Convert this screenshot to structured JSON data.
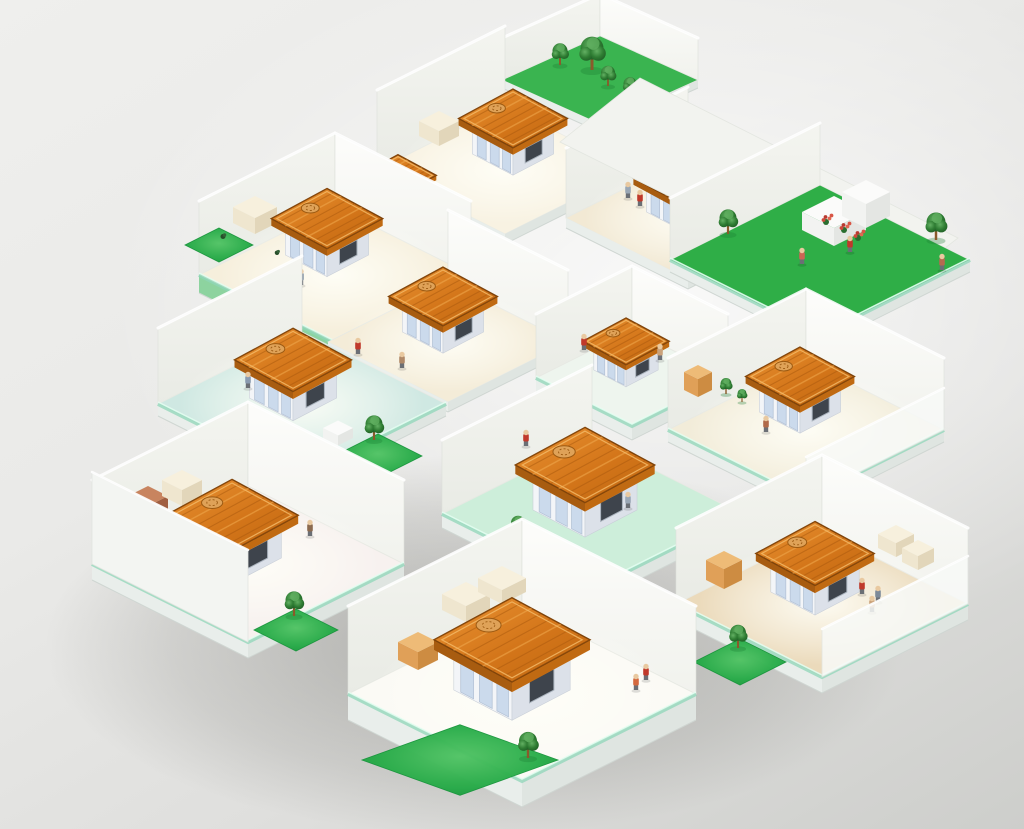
{
  "scene": {
    "type": "isometric-building-cutaway-illustration",
    "background": {
      "light": "#efefed",
      "dark": "#cdcecb"
    },
    "palette": {
      "roof_top_light": "#e89232",
      "roof_top": "#d4761a",
      "roof_top_dark": "#bd650f",
      "roof_side_left": "#a85c10",
      "roof_side_right": "#c06a12",
      "roof_grain": "#a8590e",
      "roof_grain_light": "#f0a94f",
      "roof_rim_dark": "#7e430a",
      "roof_rim_light": "#f3b866",
      "medallion": "#dfa258",
      "medallion_line": "#9c5a12",
      "hut_wall_left": "#f3f5f8",
      "hut_wall_right": "#dce1e9",
      "hut_door": "#c9d9ec",
      "hut_door_frame": "#b3c2d6",
      "hut_window": "#3e444c",
      "hut_window_frame": "#a9b2bc",
      "wall_nw_top": "#f4f5f0",
      "wall_nw_bottom": "#e9ebe5",
      "wall_ne_top": "#fdfdfb",
      "wall_ne_bottom": "#f1f2ed",
      "front_wall_sw": "#f3f5f2",
      "front_wall_se": "#f8faf8",
      "slab_left": "#e9eeeb",
      "slab_right": "#dfe5e1",
      "slab_green_left": "#82cf97",
      "slab_green_right": "#58bd7d",
      "glass_rim": "#8fd6b8",
      "glass_rim_light": "#e7fff3",
      "lawn_light": "#52c465",
      "lawn": "#28ac49",
      "lawn_dark": "#149238",
      "lawn_stroke": "#18953c",
      "tree_light": "#63b063",
      "tree": "#2f7d33",
      "tree_dark": "#1e5a24",
      "tree_highlight": "#5fae5f",
      "trunk": "#8a5a2b",
      "skin": "#e9c9a0",
      "legs": "#6b6f75",
      "flower_reds": [
        "#cf4a3c",
        "#e06852",
        "#b93a30",
        "#d85545"
      ],
      "furn_cream": {
        "L": "#efe6cf",
        "R": "#e2d6ba",
        "T": "#f7f0dd"
      },
      "furn_white": {
        "L": "#f2f3f1",
        "R": "#e4e6e3",
        "T": "#fbfbfa"
      },
      "furn_brick": {
        "L": "#b5714f",
        "R": "#a05f41",
        "T": "#c8845f"
      },
      "furn_orange": {
        "L": "#e0a058",
        "R": "#cd8c42",
        "T": "#eebb77"
      }
    },
    "shadow": {
      "cx": 475,
      "cy": 645,
      "rx": 430,
      "ry": 190
    },
    "rooms": [
      {
        "name": "roof-garden",
        "cx": 600,
        "cy": 80,
        "w": 98,
        "ratio": 0.45,
        "floor": "#3ab450",
        "wallH": 42,
        "walls": [
          "nw",
          "ne"
        ],
        "slabT": 8,
        "trees": [
          {
            "dx": -40,
            "dy": -15,
            "s": 0.75
          },
          {
            "dx": -8,
            "dy": -10,
            "s": 1.15
          },
          {
            "dx": 8,
            "dy": 6,
            "s": 0.7
          },
          {
            "dx": 30,
            "dy": 16,
            "s": 0.65
          }
        ]
      },
      {
        "name": "room-top",
        "cx": 505,
        "cy": 170,
        "w": 128,
        "floor": "#f8f2e2",
        "wallH": 80,
        "walls": [
          "nw"
        ],
        "slabT": 10,
        "glow": true,
        "hut": {
          "dx": 8,
          "dy": -16,
          "s": 0.78
        },
        "furn": [
          {
            "dx": -66,
            "dy": -34,
            "a": 20,
            "h": 15,
            "c": "cream"
          }
        ]
      },
      {
        "name": "room-upper-back",
        "cx": 398,
        "cy": 208,
        "w": 70,
        "floor": "#f6f0e0",
        "wallH": 0,
        "walls": [],
        "slabT": 0,
        "hut": {
          "dx": 0,
          "dy": -7,
          "s": 0.55
        }
      },
      {
        "name": "room-upper-right",
        "cx": 688,
        "cy": 218,
        "w": 122,
        "floor": "#f2e9d4",
        "wallH": 70,
        "walls": [
          "nw"
        ],
        "slabT": 10,
        "glow": true,
        "hut": {
          "dx": -3,
          "dy": -6,
          "s": 0.74
        },
        "furn": [
          {
            "dx": 58,
            "dy": -42,
            "a": 18,
            "h": 12,
            "c": "cream"
          }
        ],
        "figures": [
          {
            "dx": -60,
            "dy": -20,
            "c": "#9aa7b5"
          },
          {
            "dx": -48,
            "dy": -12,
            "c": "#c0392b"
          }
        ]
      },
      {
        "name": "terrace-right",
        "cx": 820,
        "cy": 260,
        "w": 150,
        "floor": "#2fae47",
        "wallH": 62,
        "walls": [
          "nw"
        ],
        "slabT": 12,
        "glassRim": true,
        "prePolys": [
          {
            "pts": [
              [
                640,
                78
              ],
              [
                958,
                238
              ],
              [
                878,
                300
              ],
              [
                560,
                142
              ]
            ],
            "fill": "#f2f3ef",
            "n": "roof-deck"
          },
          {
            "pts": [
              [
                772,
                168
              ],
              [
                798,
                155
              ],
              [
                798,
                232
              ],
              [
                772,
                245
              ]
            ],
            "fill": "#f6f7f4",
            "n": "pillar"
          }
        ],
        "counters": [
          {
            "dx": 14,
            "dy": -30,
            "a": 32,
            "h": 18
          },
          {
            "dx": 46,
            "dy": -44,
            "a": 24,
            "h": 24
          }
        ],
        "flowers": [
          {
            "dx": 6,
            "dy": -40
          },
          {
            "dx": 24,
            "dy": -32
          },
          {
            "dx": 38,
            "dy": -24
          }
        ],
        "trees": [
          {
            "dx": -92,
            "dy": -26,
            "s": 0.85
          },
          {
            "dx": 116,
            "dy": -20,
            "s": 0.95
          }
        ],
        "figures": [
          {
            "dx": 30,
            "dy": -8,
            "c": "#c0392b"
          },
          {
            "dx": -18,
            "dy": 4,
            "c": "#cc6655"
          },
          {
            "dx": 122,
            "dy": 10,
            "c": "#b56a50"
          }
        ]
      },
      {
        "name": "room-upper-left",
        "cx": 335,
        "cy": 275,
        "w": 136,
        "floor": "#f6efdc",
        "wallH": 74,
        "walls": [
          "nw",
          "ne"
        ],
        "slabT": 18,
        "slabColor": "green",
        "glassRim": true,
        "glow": true,
        "hut": {
          "dx": -8,
          "dy": -20,
          "s": 0.8
        },
        "lawns": [
          {
            "dx": -116,
            "dy": -30,
            "w": 34
          }
        ],
        "shrubs": [
          {
            "dx": -112,
            "dy": -36,
            "s": 0.5
          },
          {
            "dx": -58,
            "dy": -20,
            "s": 0.45
          }
        ],
        "furn": [
          {
            "dx": -80,
            "dy": -52,
            "a": 22,
            "h": 16,
            "c": "cream"
          }
        ],
        "figures": [
          {
            "dx": -34,
            "dy": 10,
            "c": "#8c9aa8"
          }
        ]
      },
      {
        "name": "room-mid-center",
        "cx": 448,
        "cy": 342,
        "w": 120,
        "floor": "#f4ecd8",
        "wallH": 72,
        "walls": [
          "ne"
        ],
        "slabT": 10,
        "glow": true,
        "hut": {
          "dx": -5,
          "dy": -10,
          "s": 0.78
        },
        "figures": [
          {
            "dx": -46,
            "dy": 26,
            "c": "#b08968"
          }
        ]
      },
      {
        "name": "room-mid-right",
        "cx": 632,
        "cy": 378,
        "w": 96,
        "floor": "#eef5ee",
        "wallH": 64,
        "walls": [
          "nw",
          "ne"
        ],
        "slabT": 14,
        "glassRim": true,
        "hut": {
          "dx": -6,
          "dy": -8,
          "s": 0.62
        },
        "figures": [
          {
            "dx": -48,
            "dy": -28,
            "c": "#c0392b"
          },
          {
            "dx": 28,
            "dy": -18,
            "c": "#caa27a"
          },
          {
            "dx": -50,
            "dy": 26,
            "c": "#c0392b"
          }
        ]
      },
      {
        "name": "room-mid-left",
        "cx": 302,
        "cy": 404,
        "w": 144,
        "floor": "#cfe8e2",
        "wallH": 76,
        "walls": [
          "nw"
        ],
        "slabT": 12,
        "glassRim": true,
        "glow": true,
        "hut": {
          "dx": -9,
          "dy": -6,
          "s": 0.84
        },
        "furn": [
          {
            "dx": 36,
            "dy": 34,
            "a": 15,
            "h": 10,
            "c": "white"
          }
        ],
        "lawns": [
          {
            "dx": 76,
            "dy": 52,
            "w": 44
          }
        ],
        "trees": [
          {
            "dx": 72,
            "dy": 36,
            "s": 0.85
          }
        ],
        "figures": [
          {
            "dx": 56,
            "dy": -50,
            "c": "#c0392b"
          },
          {
            "dx": -54,
            "dy": -16,
            "c": "#8a9bb0"
          }
        ]
      },
      {
        "name": "room-right",
        "cx": 806,
        "cy": 430,
        "w": 138,
        "floor": "#f2ecd9",
        "wallH": 72,
        "walls": [
          "nw",
          "ne"
        ],
        "frontWalls": [
          {
            "side": "se",
            "h": 42,
            "op": 0.85
          }
        ],
        "slabT": 12,
        "glassRim": true,
        "glow": true,
        "hut": {
          "dx": -6,
          "dy": -18,
          "s": 0.78
        },
        "furn": [
          {
            "dx": -108,
            "dy": -40,
            "a": 14,
            "h": 18,
            "c": "orange"
          }
        ],
        "trees": [
          {
            "dx": -80,
            "dy": -36,
            "s": 0.55
          },
          {
            "dx": -64,
            "dy": -28,
            "s": 0.45
          }
        ],
        "figures": [
          {
            "dx": -40,
            "dy": 2,
            "c": "#b06a4a"
          }
        ]
      },
      {
        "name": "room-center",
        "cx": 592,
        "cy": 514,
        "w": 150,
        "floor": "#cdeeda",
        "wallH": 74,
        "walls": [
          "nw"
        ],
        "slabT": 14,
        "glassRim": true,
        "hut": {
          "dx": -7,
          "dy": -4,
          "s": 1.0
        },
        "trees": [
          {
            "dx": -74,
            "dy": 22,
            "s": 0.7
          },
          {
            "dx": -12,
            "dy": 56,
            "s": 0.7
          }
        ],
        "figures": [
          {
            "dx": 36,
            "dy": -6,
            "c": "#9aa7b5"
          },
          {
            "dx": -66,
            "dy": -68,
            "c": "#c0392b"
          }
        ]
      },
      {
        "name": "room-left",
        "cx": 248,
        "cy": 564,
        "w": 156,
        "floor": "#f7f1ef",
        "wallH": 84,
        "walls": [
          "nw",
          "ne"
        ],
        "frontWalls": [
          {
            "side": "sw",
            "h": 92,
            "op": 1
          }
        ],
        "slabT": 16,
        "glassRim": true,
        "glow": true,
        "hut": {
          "dx": -16,
          "dy": -6,
          "s": 0.95
        },
        "furn": [
          {
            "dx": -100,
            "dy": -46,
            "a": 20,
            "h": 22,
            "c": "brick"
          },
          {
            "dx": -66,
            "dy": -68,
            "a": 20,
            "h": 16,
            "c": "cream"
          },
          {
            "dx": -122,
            "dy": -28,
            "a": 14,
            "h": 24,
            "c": "white"
          }
        ],
        "lawns": [
          {
            "dx": 48,
            "dy": 66,
            "w": 42
          }
        ],
        "trees": [
          {
            "dx": 46,
            "dy": 52,
            "s": 0.85
          }
        ],
        "figures": [
          {
            "dx": 62,
            "dy": -28,
            "c": "#8c6a4f"
          }
        ]
      },
      {
        "name": "room-bottom-right",
        "cx": 822,
        "cy": 604,
        "w": 146,
        "floor": "#ebdabb",
        "wallH": 76,
        "walls": [
          "nw",
          "ne"
        ],
        "frontWalls": [
          {
            "side": "se",
            "h": 48,
            "op": 0.85
          }
        ],
        "slabT": 16,
        "glassRim": true,
        "glow": true,
        "hut": {
          "dx": -7,
          "dy": -12,
          "s": 0.85
        },
        "furn": [
          {
            "dx": -98,
            "dy": -24,
            "a": 18,
            "h": 20,
            "c": "orange"
          },
          {
            "dx": 74,
            "dy": -56,
            "a": 18,
            "h": 14,
            "c": "cream"
          },
          {
            "dx": 96,
            "dy": -42,
            "a": 16,
            "h": 14,
            "c": "cream"
          }
        ],
        "lawns": [
          {
            "dx": -82,
            "dy": 58,
            "w": 46
          }
        ],
        "trees": [
          {
            "dx": -84,
            "dy": 44,
            "s": 0.8
          }
        ],
        "figures": [
          {
            "dx": 40,
            "dy": -10,
            "c": "#c0392b"
          },
          {
            "dx": 56,
            "dy": -2,
            "c": "#7d8a99"
          },
          {
            "dx": 50,
            "dy": 8,
            "c": "#caa27a"
          }
        ]
      },
      {
        "name": "room-bottom",
        "cx": 522,
        "cy": 694,
        "w": 174,
        "floor": "#fbfaf5",
        "wallH": 88,
        "walls": [
          "nw",
          "ne"
        ],
        "slabT": 26,
        "glassRim": true,
        "glow": true,
        "hut": {
          "dx": -10,
          "dy": -4,
          "s": 1.12
        },
        "furn": [
          {
            "dx": -104,
            "dy": -34,
            "a": 20,
            "h": 18,
            "c": "orange"
          },
          {
            "dx": -56,
            "dy": -84,
            "a": 24,
            "h": 16,
            "c": "cream"
          },
          {
            "dx": -20,
            "dy": -102,
            "a": 24,
            "h": 14,
            "c": "cream"
          }
        ],
        "lawns": [
          {
            "dx": -62,
            "dy": 66,
            "w": 98,
            "ratio": 0.36
          }
        ],
        "trees": [
          {
            "dx": 6,
            "dy": 64,
            "s": 0.9
          }
        ],
        "figures": [
          {
            "dx": 124,
            "dy": -14,
            "c": "#c0392b"
          },
          {
            "dx": 114,
            "dy": -4,
            "c": "#d4693f"
          }
        ]
      }
    ]
  }
}
